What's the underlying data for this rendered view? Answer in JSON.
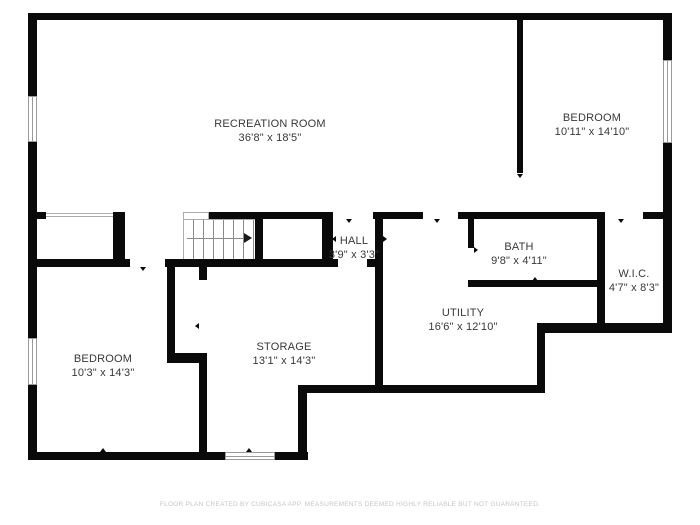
{
  "plan": {
    "rooms": [
      {
        "name": "RECREATION ROOM",
        "dims": "36'8\" x 18'5\""
      },
      {
        "name": "BEDROOM",
        "dims": "10'11\" x 14'10\""
      },
      {
        "name": "HALL",
        "dims": "3'9\" x 3'3\""
      },
      {
        "name": "BATH",
        "dims": "9'8\" x 4'11\""
      },
      {
        "name": "W.I.C.",
        "dims": "4'7\" x 8'3\""
      },
      {
        "name": "UTILITY",
        "dims": "16'6\" x 12'10\""
      },
      {
        "name": "STORAGE",
        "dims": "13'1\" x 14'3\""
      },
      {
        "name": "BEDROOM",
        "dims": "10'3\" x 14'3\""
      }
    ],
    "footer": "FLOOR PLAN CREATED BY CUBICASA APP. MEASUREMENTS DEEMED HIGHLY RELIABLE BUT NOT GUARANTEED.",
    "colors": {
      "wall": "#0a0a0a",
      "label": "#383838",
      "footer": "#c6c6c6",
      "background": "#ffffff"
    }
  }
}
